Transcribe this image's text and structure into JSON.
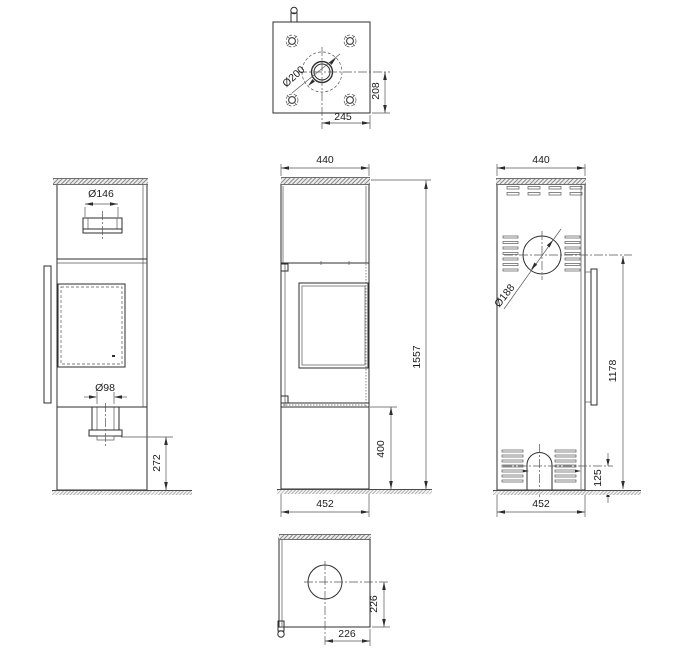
{
  "colors": {
    "line": "#2e2e2e",
    "hatch": "#8f8f8f",
    "background": "#ffffff"
  },
  "views": {
    "top_view": {
      "flue_diameter": "Ø200",
      "flue_center_to_back": "208",
      "flue_center_to_side": "245"
    },
    "side_view": {
      "top_collar_diameter": "Ø146",
      "air_inlet_diameter": "Ø98",
      "air_inlet_height": "272"
    },
    "front_view": {
      "top_width": "440",
      "total_height": "1557",
      "base_height": "400",
      "base_width": "452"
    },
    "rear_view": {
      "top_width": "440",
      "rear_outlet_diameter": "Ø188",
      "rear_outlet_height": "1178",
      "rear_inlet_height": "125",
      "base_width": "452"
    },
    "bottom_view": {
      "opening_center_to_back": "226",
      "opening_center_to_side": "226"
    }
  }
}
